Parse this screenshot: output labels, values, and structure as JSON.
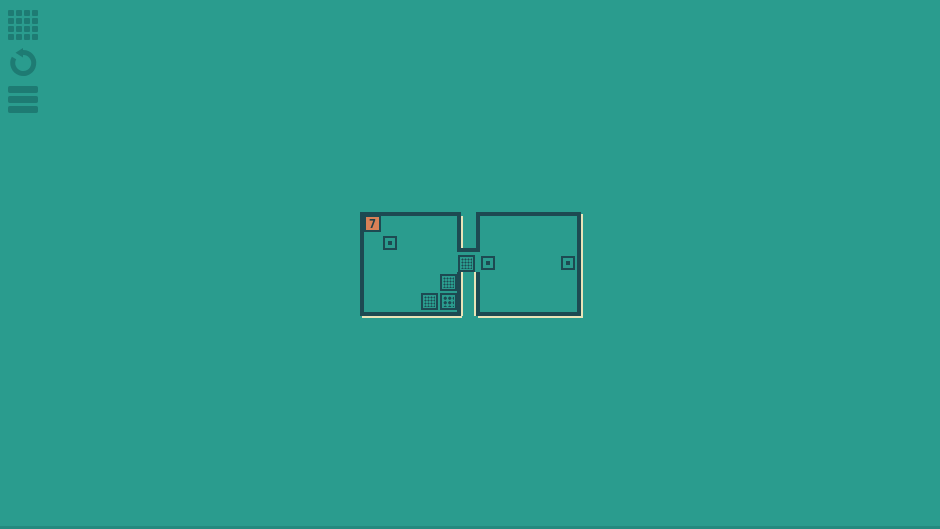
{
  "colors": {
    "bg": "#2a9c8e",
    "wall": "#1d4a52",
    "shadow": "#e9e4b8",
    "tile_bg": "#d98157",
    "tile_text": "#223f46",
    "icon": "rgba(10,70,72,0.38)"
  },
  "toolbar": {
    "buttons": [
      {
        "name": "level-select-button",
        "icon": "grid-icon",
        "top": 0
      },
      {
        "name": "restart-button",
        "icon": "restart-icon",
        "top": 38
      },
      {
        "name": "menu-button",
        "icon": "menu-icon",
        "top": 76
      }
    ]
  },
  "puzzle": {
    "offset": {
      "left": 357,
      "top": 210,
      "width": 230,
      "height": 112
    },
    "tile_label": "7",
    "walls": [
      {
        "name": "left-room-top",
        "rect": [
          3,
          2,
          101,
          4
        ]
      },
      {
        "name": "left-room-left",
        "rect": [
          3,
          2,
          4,
          104
        ]
      },
      {
        "name": "left-room-bottom",
        "rect": [
          3,
          102,
          101,
          4
        ]
      },
      {
        "name": "notch-left",
        "rect": [
          100,
          2,
          4,
          40
        ]
      },
      {
        "name": "notch-bottom",
        "rect": [
          100,
          38,
          23,
          4
        ]
      },
      {
        "name": "notch-right",
        "rect": [
          119,
          2,
          4,
          40
        ]
      },
      {
        "name": "right-room-top",
        "rect": [
          119,
          2,
          105,
          4
        ]
      },
      {
        "name": "right-room-right",
        "rect": [
          220,
          2,
          4,
          104
        ]
      },
      {
        "name": "right-room-bottom",
        "rect": [
          119,
          102,
          105,
          4
        ]
      },
      {
        "name": "slot-left",
        "rect": [
          100,
          62,
          4,
          44
        ]
      },
      {
        "name": "slot-right",
        "rect": [
          119,
          62,
          4,
          44
        ]
      }
    ],
    "shadows": [
      {
        "name": "notch-left-highlight",
        "rect": [
          104,
          6,
          2,
          32
        ]
      },
      {
        "name": "slot-left-highlight",
        "rect": [
          104,
          62,
          2,
          44
        ]
      },
      {
        "name": "slot-right-highlight",
        "rect": [
          117,
          62,
          2,
          44
        ]
      },
      {
        "name": "left-room-bottom-shadow",
        "rect": [
          5,
          106,
          100,
          2
        ]
      },
      {
        "name": "right-room-bottom-shadow",
        "rect": [
          121,
          106,
          105,
          2
        ]
      },
      {
        "name": "right-room-right-shadow",
        "rect": [
          224,
          4,
          2,
          104
        ]
      }
    ],
    "items": [
      {
        "type": "number-tile",
        "label": "7",
        "rect": [
          7,
          5,
          17,
          17
        ]
      },
      {
        "type": "dot-socket",
        "rect": [
          26,
          26,
          14,
          14
        ]
      },
      {
        "type": "dot-socket",
        "rect": [
          124,
          46,
          14,
          14
        ]
      },
      {
        "type": "dot-socket",
        "rect": [
          204,
          46,
          14,
          14
        ]
      },
      {
        "type": "hole-fine",
        "rect": [
          101,
          45,
          17,
          17
        ]
      },
      {
        "type": "hole-fine",
        "rect": [
          83,
          64,
          17,
          17
        ]
      },
      {
        "type": "hole-fine",
        "rect": [
          64,
          83,
          17,
          17
        ]
      },
      {
        "type": "hole-bold",
        "rect": [
          83,
          83,
          17,
          17
        ]
      }
    ]
  }
}
